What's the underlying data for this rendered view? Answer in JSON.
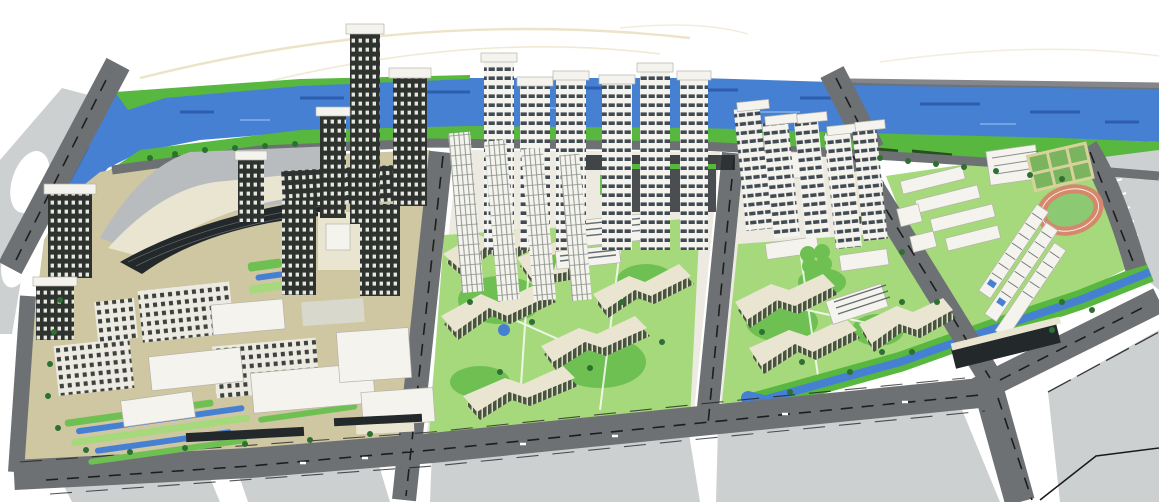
{
  "scene": {
    "type": "architectural-masterplan-aerial-rendering",
    "description": "Bird's-eye 3D rendering of a riverfront urban master plan: a blue river with green banks across the top, a dark road grid in perspective, a CBD block with waffle-grid towers and a curved convention hall, two residential superblocks with serpentine striped mid-rises and rows of riverfront high-rise towers, a school campus with running track and tennis courts, canals and landscaped plazas, on a white paper background with faint sketch lines",
    "regions": [
      {
        "name": "river",
        "label": "River with current streaks"
      },
      {
        "name": "riverfront-banks",
        "label": "Green river banks with tree rows"
      },
      {
        "name": "road-network",
        "label": "Perspective road grid with lane markings and bridges"
      },
      {
        "name": "cbd-block",
        "label": "CBD block: convention hall, C-shaped grid mega-block, towers, tan plaza"
      },
      {
        "name": "residential-block-west",
        "label": "Residential superblock with serpentine buildings and tower row",
        "towers": 10,
        "serpentines": 6
      },
      {
        "name": "residential-block-east",
        "label": "Residential superblock with serpentine buildings and leaning towers",
        "towers": 5,
        "serpentines": 4
      },
      {
        "name": "school-block",
        "label": "School campus: slab classrooms, gymnasium, tennis courts, running track, twin towers"
      },
      {
        "name": "canal",
        "label": "Canal with green banks along the southeast road"
      },
      {
        "name": "paved-parcels",
        "label": "Light paved future parcels south of the main road"
      },
      {
        "name": "sketch-lines",
        "label": "Faint hand-sketch arcs on white background"
      }
    ]
  },
  "palette": {
    "paper": "#ffffff",
    "river": "#4680d2",
    "riverdark": "#2a57a8",
    "riverglint": "#7aa7e4",
    "bank": "#57b73f",
    "lawn": "#a6d87c",
    "courtyard": "#6fc052",
    "tree": "#2e7032",
    "hedge": "#20321f",
    "road": "#6e7174",
    "lane": "#1d1d1d",
    "paving": "#cdd0d1",
    "parceledge": "#34383a",
    "plaza": "#cfc6a2",
    "cream": "#e9e5d0",
    "bldgwhite": "#f4f3ee",
    "bldgline": "#b5b4a9",
    "shade": "#d9d8cd",
    "facadedark": "#2e3330",
    "windowlight": "#e6e7e0",
    "facadelight": "#eceae1",
    "windowdark": "#3c433e",
    "towerband": "#424b52",
    "serp": "#49533e",
    "serpstripe": "#d8ddc5",
    "vstripe": "#8f958e",
    "glass": "#23282b",
    "greyroof": "#b8bcbe",
    "podium": "#4a4e50",
    "track": "#d5886b",
    "infield": "#8cc973",
    "court": "#d7d29b",
    "courtgreen": "#7ab45e",
    "sketch": "#ece3c8"
  }
}
